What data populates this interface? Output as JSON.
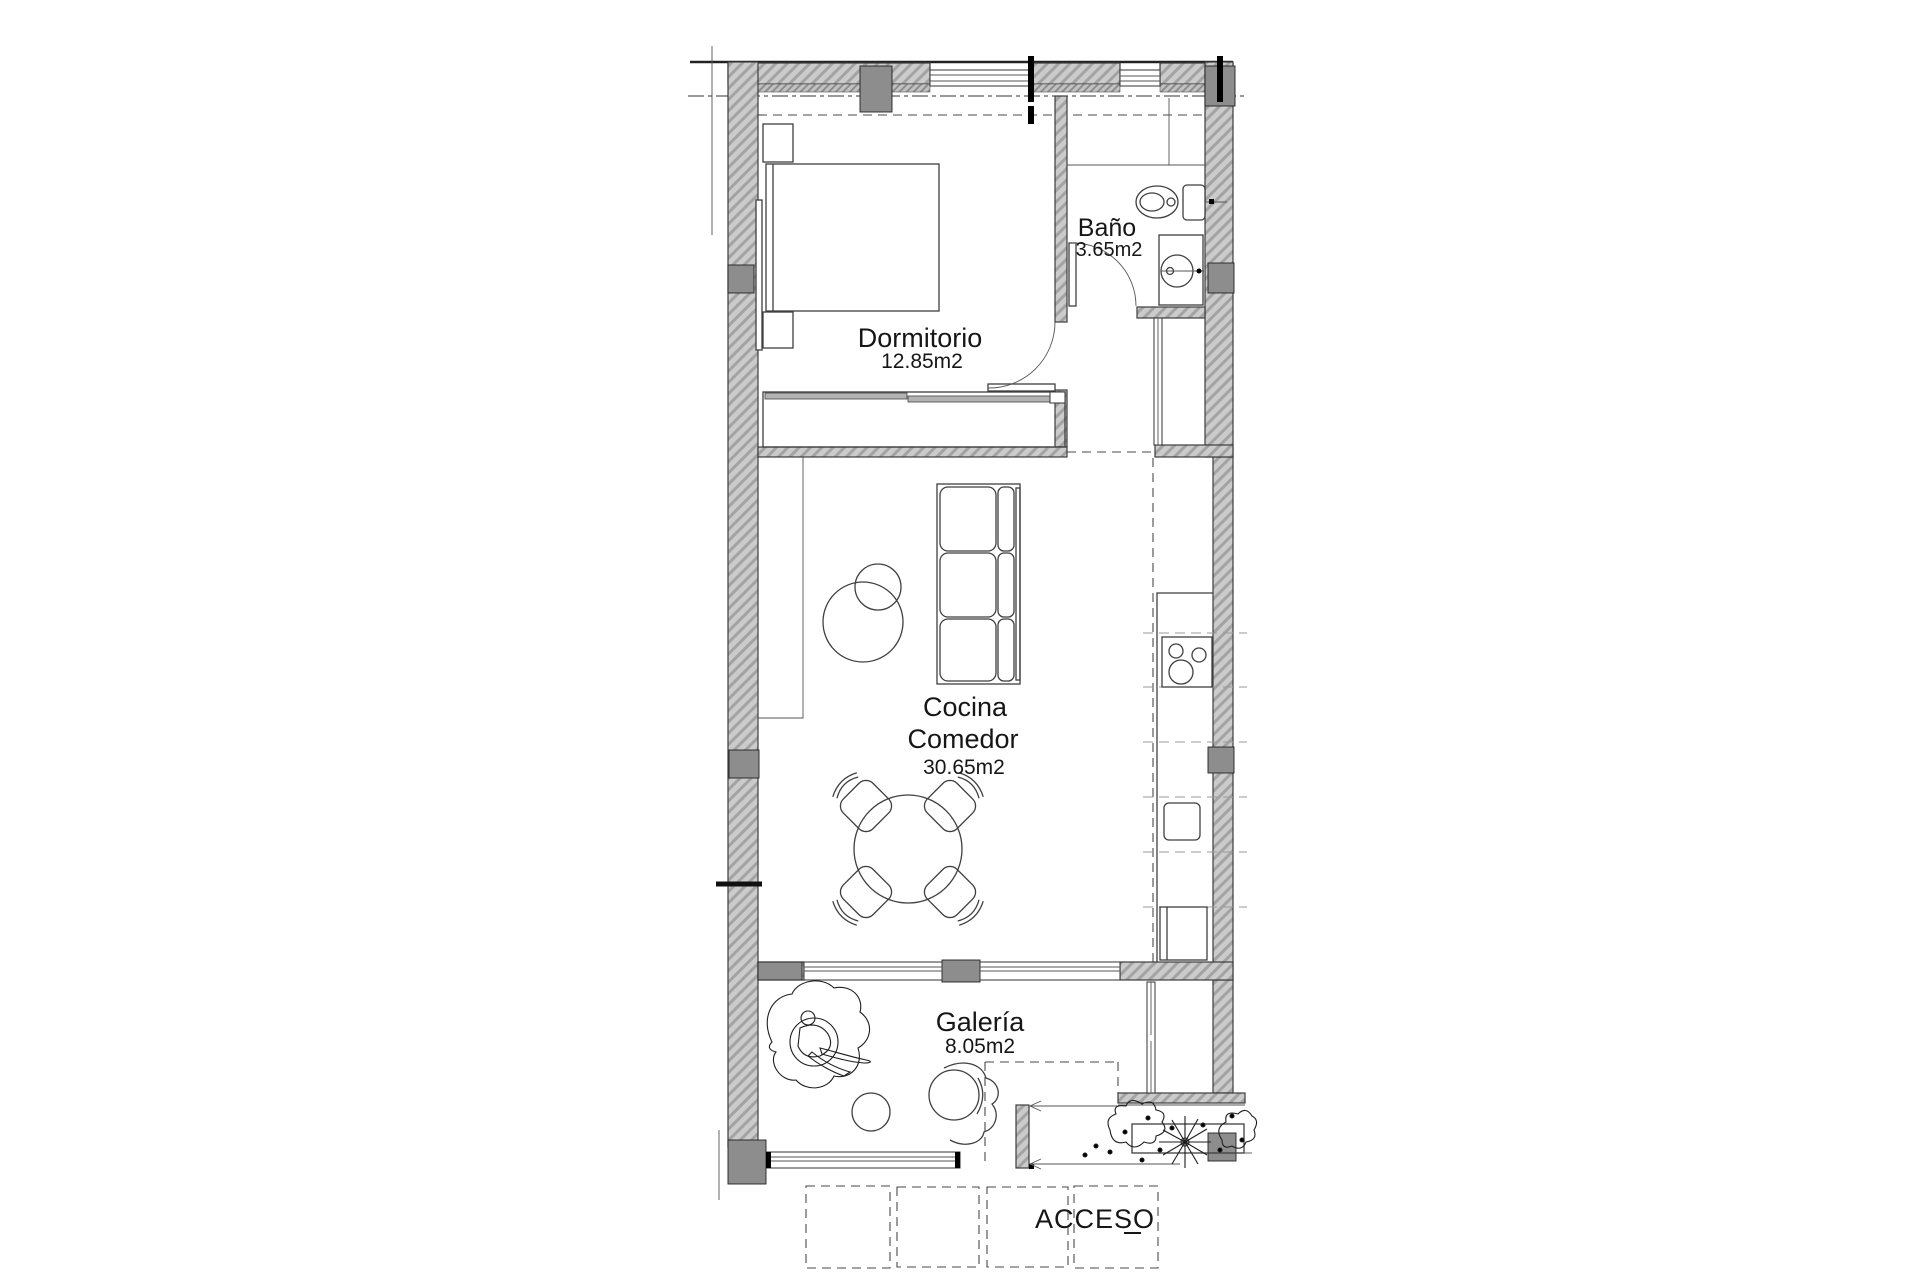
{
  "rooms": {
    "bedroom": {
      "name": "Dormitorio",
      "area": "12.85m2"
    },
    "bathroom": {
      "name": "Baño",
      "area": "3.65m2"
    },
    "kitchen_dining": {
      "name_line1": "Cocina",
      "name_line2": "Comedor",
      "area": "30.65m2"
    },
    "gallery": {
      "name": "Galería",
      "area": "8.05m2"
    }
  },
  "entrance": {
    "label": "ACCESO"
  },
  "furniture_symbols": [
    "bed",
    "nightstand",
    "wardrobe",
    "sofa",
    "coffee-table",
    "dining-table",
    "dining-chair",
    "toilet",
    "washbasin",
    "hob",
    "kitchen-sink",
    "fridge",
    "plant",
    "armchair",
    "side-table",
    "planter",
    "steps",
    "paving-slabs"
  ],
  "colors": {
    "wall_fill": "#cbcbcb",
    "wall_hatch_line": "#a3a3a3",
    "column_fill": "#8d8d8d",
    "outline": "#3c3c3c",
    "text": "#161616",
    "guide_dashed": "#9a9a9a"
  }
}
